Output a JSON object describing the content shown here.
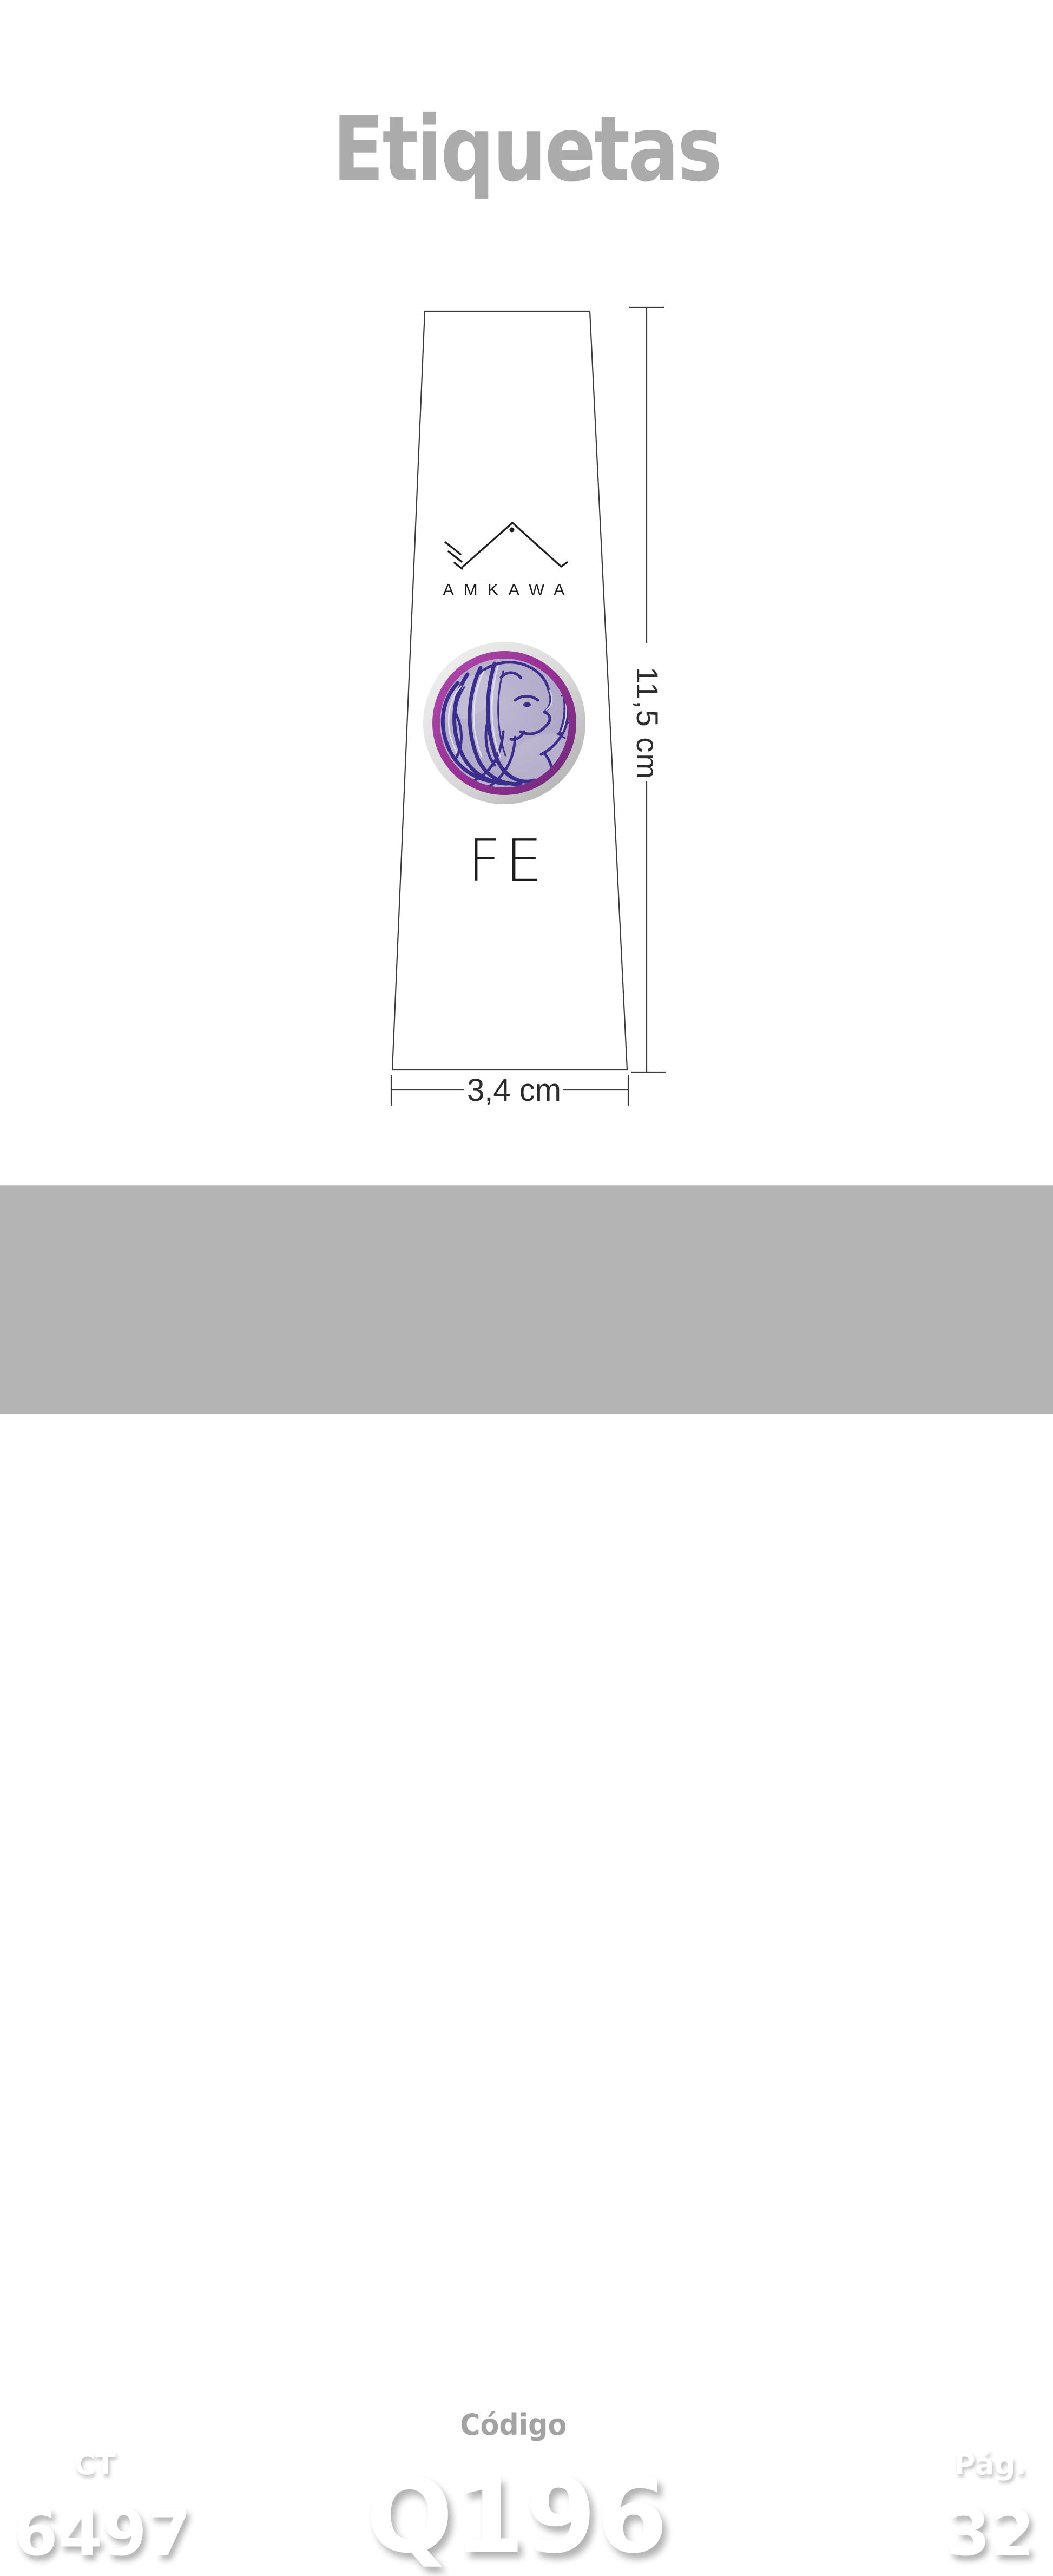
{
  "page": {
    "title": "Etiquetas"
  },
  "diagram": {
    "brand": "AMKAWA",
    "label_text": "FE",
    "height_dimension": "11,5 cm",
    "width_dimension": "3,4 cm",
    "watermark_fragment": "UBR"
  },
  "footer": {
    "ct_label": "CT",
    "ct_value": "6497",
    "code_label": "Código",
    "code_value": "Q196",
    "page_label": "Pág.",
    "page_value": "32"
  },
  "colors": {
    "title_gray": "#ababab",
    "footer_bg": "#b4b4b4",
    "code_text": "#a2a2a2",
    "line": "#3a3a3a",
    "ink": "#1d1d1d",
    "emblem_magenta": "#9a3297",
    "emblem_lavender": "#b0a9c6",
    "emblem_ink": "#3b2e8c"
  }
}
